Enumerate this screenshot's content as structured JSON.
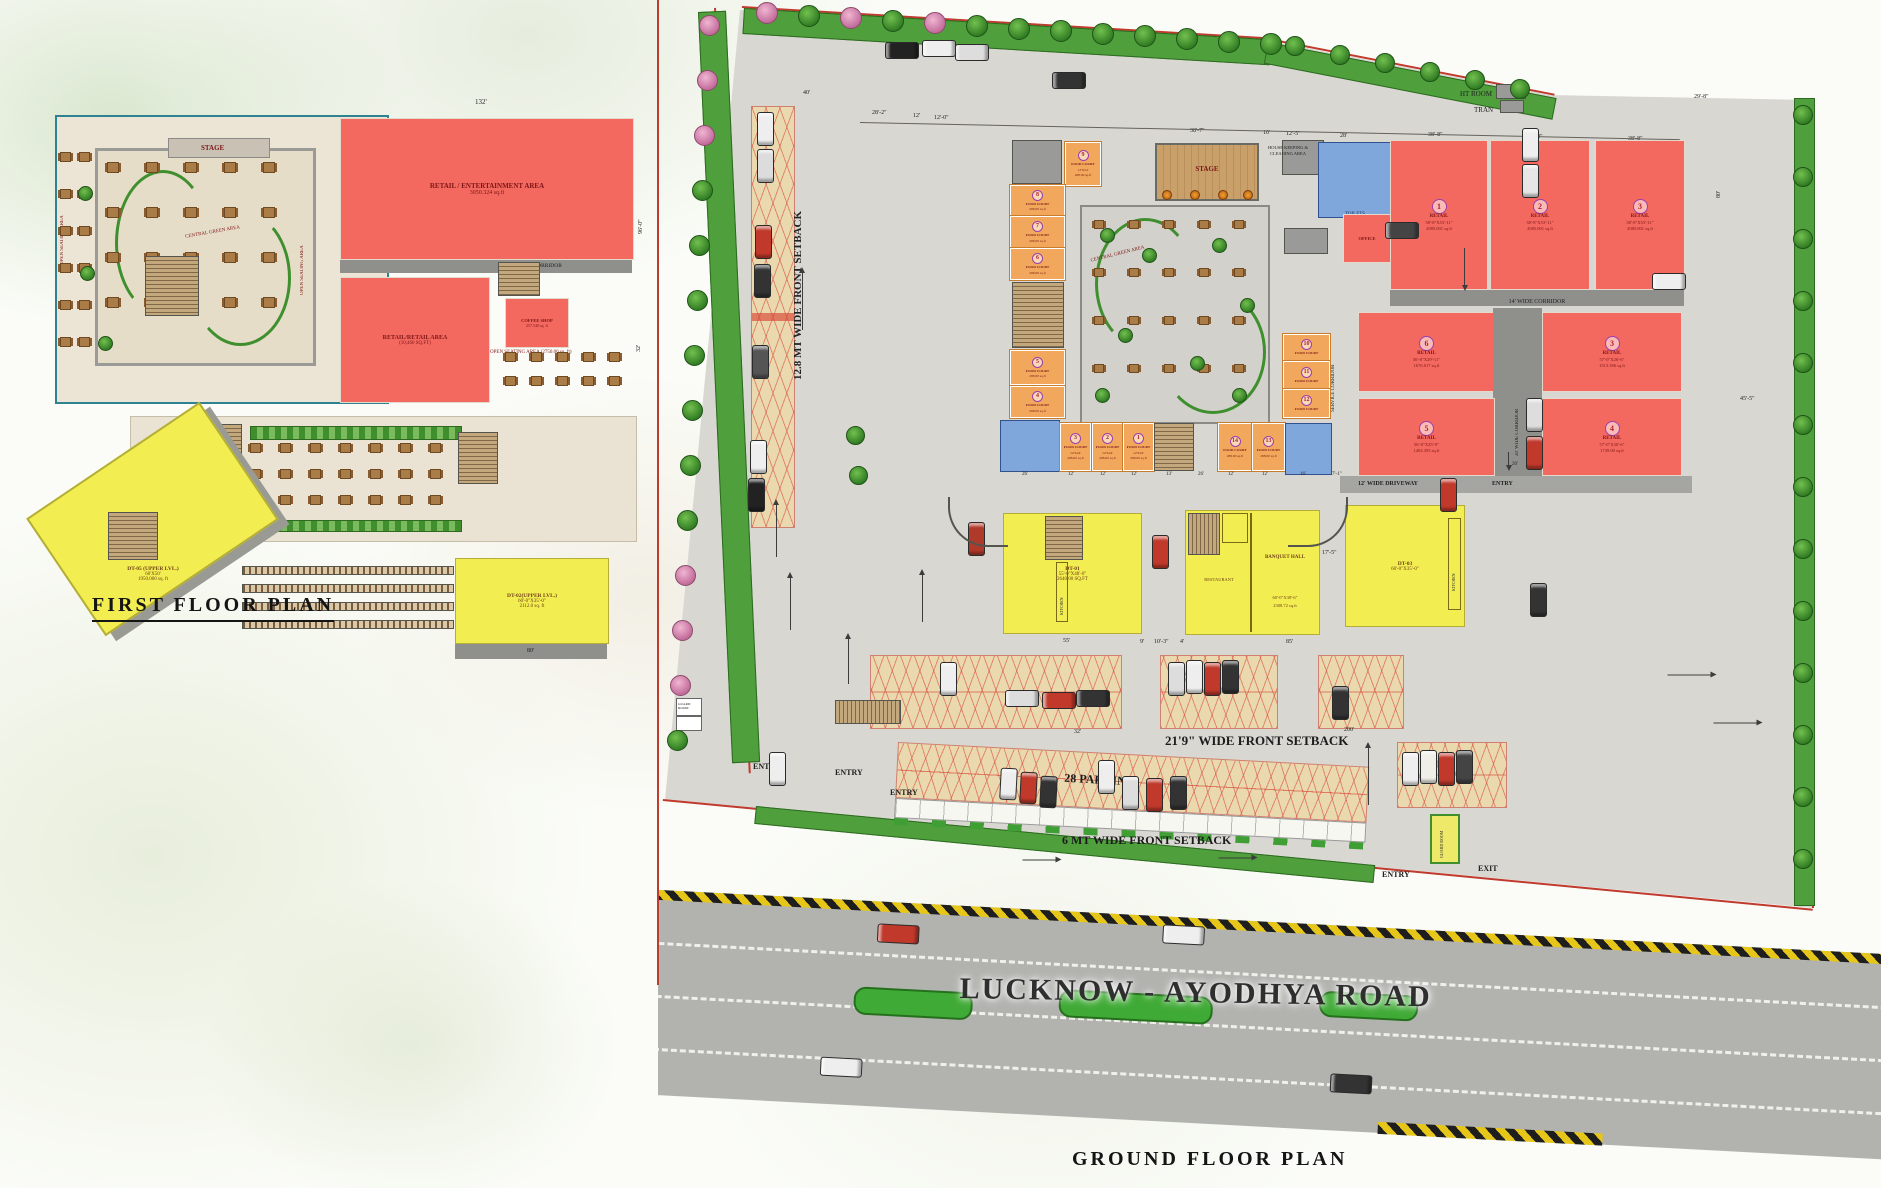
{
  "page": {
    "first_floor_title": "FIRST  FLOOR PLAN",
    "ground_floor_title": "GROUND  FLOOR PLAN",
    "road_name": "LUCKNOW - AYODHYA ROAD",
    "accent_colors": {
      "retail_red": "#f3685f",
      "anchor_yellow": "#f2ee52",
      "food_court_orange": "#f2a85c",
      "toilet_blue": "#7fa7dc",
      "green": "#4f9f3d",
      "boundary_red": "#c03a2e"
    }
  },
  "first_floor": {
    "stage": "STAGE",
    "open_seating_side": "OPEN SEATING AREA",
    "central_green": "CENTRAL GREEN AREA",
    "retail_entertainment": [
      "RETAIL / ENTERTAINMENT AREA",
      "3050.324  sq.ft"
    ],
    "corridor": "14' WIDE CORRIDOR",
    "retail_retail": [
      "RETAIL/RETAIL AREA",
      "(10,460 SQ.FT)"
    ],
    "coffee_shop": [
      "COFFEE SHOP",
      "257.540 sq. ft"
    ],
    "open_seating_note": "OPEN SEATING AREA (2750.00 sq. ft)",
    "dt05": [
      "DT-05 (UPPER LVL.)",
      "60'X50'",
      "1950.000 sq. ft"
    ],
    "dt02": [
      "DT-02(UPPER LVL.)",
      "60'-0\"X35'-0\"",
      "2112.0  sq. ft"
    ],
    "dims": {
      "top": "132'",
      "right": "96'-0\"",
      "bottom": "80'",
      "side": "32'"
    }
  },
  "ground_floor": {
    "setback_left": "12.8 MT WIDE FRONT  SETBACK",
    "setback_right": "14 MT WIDE SIDE SETBACK",
    "setback_front1": "21'9\"  WIDE FRONT SETBACK",
    "setback_front2": "6 MT WIDE FRONT SETBACK",
    "parking28": "28 PARKING",
    "ht_room": "HT ROOM",
    "tran": "TRAN",
    "stage": "STAGE",
    "housekeeping": [
      "HOUSE KEEPING &",
      "CLEANING AREA"
    ],
    "toilets": "TOILETS",
    "office": "OFFICE",
    "central_green": "CENTRAL GREEN AREA",
    "service_corridor": "SERVICE CORRIDOR",
    "corridor14": "14' WIDE CORRIDOR",
    "corridor20": "20' WIDE CORRIDOR",
    "driveway12": "12' WIDE DRIVEWAY",
    "entry": "ENTRY",
    "exit": "EXIT",
    "guard": "GUARD ROOM",
    "kitchen": "KITCHEN",
    "restaurant": "RESTAURANT",
    "dt01": [
      "DT-01",
      "55'-0\"X48'-0\"",
      "2640.00 SQ.FT"
    ],
    "banquet": [
      "BANQUET HALL",
      "60'-0\"X38'-6\"",
      "2308.72 sq.ft"
    ],
    "dt03": [
      "DT-03",
      "60'-0\"X35'-0\""
    ],
    "food_court": {
      "label": "FOOD COURT",
      "size": "12'X24'",
      "area": "288.00 sq.ft",
      "numbers": [
        "9",
        "8",
        "7",
        "6",
        "5",
        "4",
        "3",
        "2",
        "1",
        "14",
        "13",
        "10",
        "11",
        "12"
      ]
    },
    "retail_units": [
      {
        "num": "1",
        "name": "RETAIL",
        "size": "38'-8\"X53'-11\"",
        "area": "2085.001  sq.ft"
      },
      {
        "num": "2",
        "name": "RETAIL",
        "size": "38'-8\"X53'-11\"",
        "area": "2085.001  sq.ft"
      },
      {
        "num": "3",
        "name": "RETAIL",
        "size": "38'-8\"X53'-11\"",
        "area": "2085.001  sq.ft"
      },
      {
        "num": "6",
        "name": "RETAIL",
        "size": "56'-0\"X29'-11\"",
        "area": "1676.017 sq.ft"
      },
      {
        "num": "3",
        "name": "RETAIL",
        "size": "57'-0\"X26'-6\"",
        "area": "1513.386 sq.ft"
      },
      {
        "num": "5",
        "name": "RETAIL",
        "size": "56'-0\"X25'-0\"",
        "area": "1402.395 sq.ft"
      },
      {
        "num": "4",
        "name": "RETAIL",
        "size": "57'-0\"X30'-6\"",
        "area": "1739.00 sq.ft"
      }
    ],
    "top_dims": [
      "40'",
      "28'-2\"",
      "12'",
      "12'-0\"",
      "38'-7\"",
      "10'",
      "12'-5\"",
      "28'",
      "38'-8\"",
      "38'-8\"",
      "38'-8\""
    ],
    "stall_dims": [
      "26'",
      "12'",
      "12'",
      "12'",
      "13'",
      "26'",
      "12'",
      "12'",
      "16'",
      "7'-1\""
    ],
    "mid_dims": [
      "55'",
      "9'",
      "10'-3\"",
      "4'",
      "85'",
      "17'-5\""
    ],
    "misc_dims": [
      "32'",
      "200'",
      "20'",
      "29'-8\"",
      "80'",
      "45'-5\""
    ]
  }
}
